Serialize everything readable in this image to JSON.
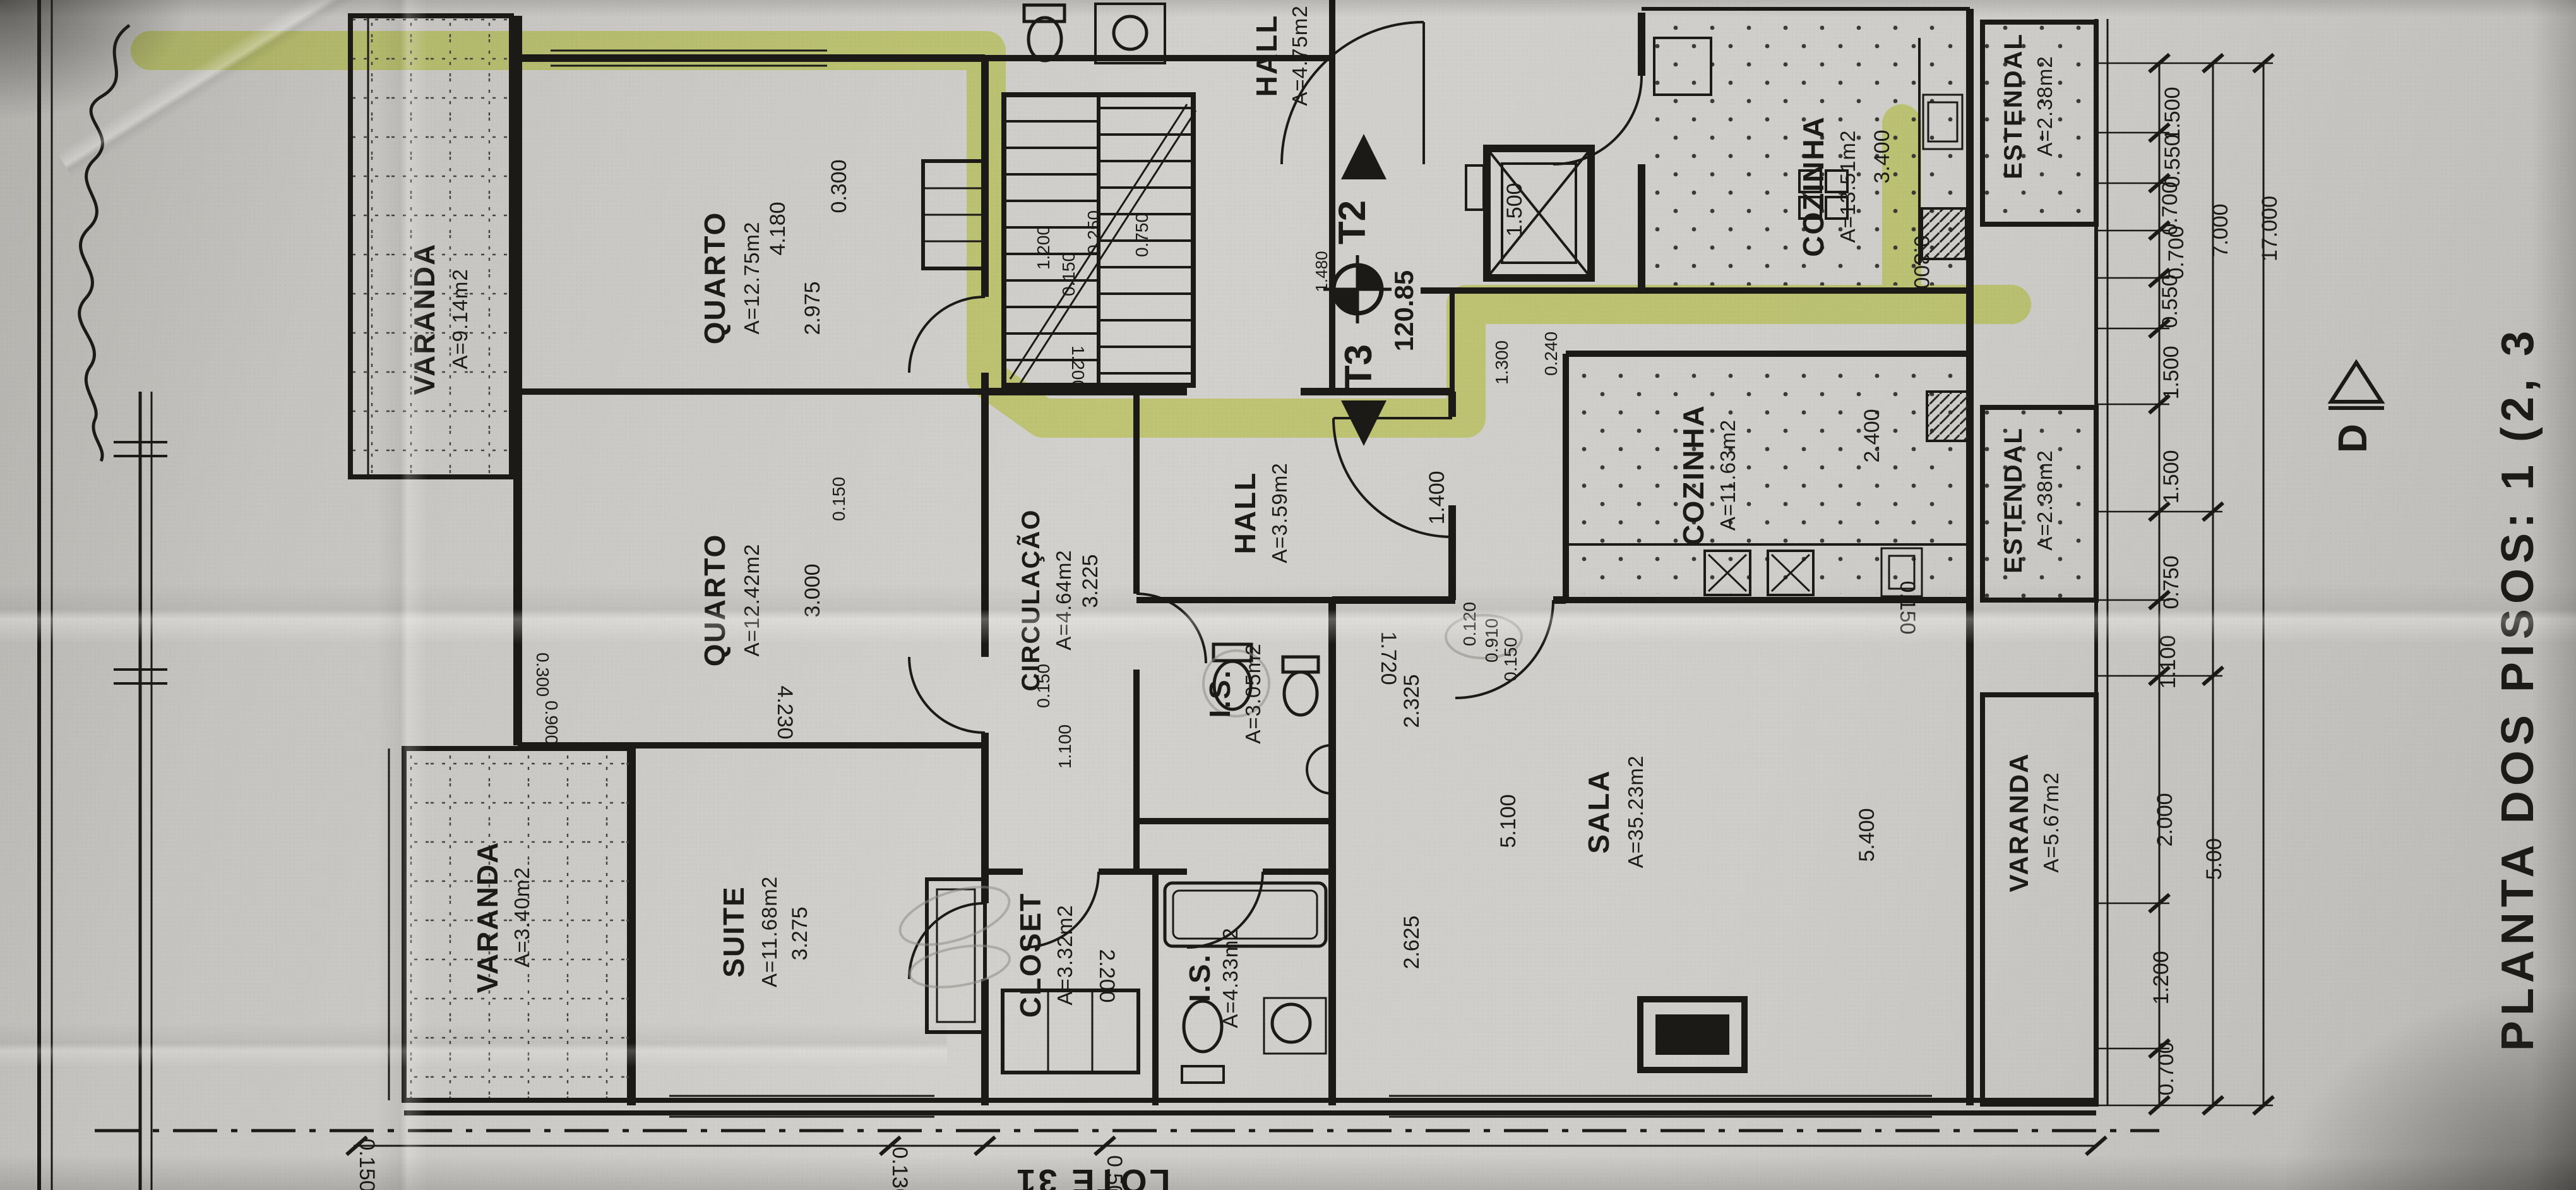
{
  "title": "PLANTA DOS PISOS: 1 (2, 3",
  "lot_label": "LOTE 31",
  "section_marker": "D",
  "markers": {
    "t2": "T2",
    "t3": "T3",
    "level": "120.85",
    "level_sub": "1.480"
  },
  "rooms": [
    {
      "label": "VARANDA",
      "area": "A=9.14m2"
    },
    {
      "label": "QUARTO",
      "area": "A=12.75m2"
    },
    {
      "label": "QUARTO",
      "area": "A=12.42m2"
    },
    {
      "label": "SUITE",
      "area": "A=11.68m2"
    },
    {
      "label": "VARANDA",
      "area": "A=3.40m2"
    },
    {
      "label": "CLOSET",
      "area": "A=3.32m2"
    },
    {
      "label": "I.S.",
      "area": "A=3.05m2"
    },
    {
      "label": "I.S.",
      "area": "A=4.33m2"
    },
    {
      "label": "CIRCULAÇÃO",
      "area": "A=4.64m2"
    },
    {
      "label": "HALL",
      "area": "A=3.59m2"
    },
    {
      "label": "HALL",
      "area": "A=4.75m2"
    },
    {
      "label": "SALA",
      "area": "A=35.23m2"
    },
    {
      "label": "COZINHA",
      "area": "A=13.51m2"
    },
    {
      "label": "COZINHA",
      "area": "A=11.63m2"
    },
    {
      "label": "ESTENDAL",
      "area": "A=2.38m2"
    },
    {
      "label": "ESTENDAL",
      "area": "A=2.38m2"
    },
    {
      "label": "VARANDA",
      "area": "A=5.67m2"
    }
  ],
  "dims": [
    "1.500",
    "0.550",
    "0.700",
    "0.700",
    "0.550",
    "1.500",
    "1.500",
    "0.750",
    "1.100",
    "2.000",
    "1.200",
    "0.700",
    "7.000",
    "5.00",
    "17.000",
    "0.300",
    "4.180",
    "2.975",
    "3.000",
    "4.230",
    "3.275",
    "2.200",
    "3.225",
    "0.150",
    "1.100",
    "1.400",
    "1.720",
    "2.325",
    "0.120",
    "0.910",
    "0.150",
    "5.100",
    "5.400",
    "2.625",
    "3.400",
    "0.300",
    "2.400",
    "0.150",
    "1.500",
    "1.300",
    "0.240",
    "1.200",
    "0.250",
    "0.750",
    "0.150",
    "1.200",
    "0.300",
    "0.900",
    "0.130",
    "0.50",
    "0.150",
    "0.150"
  ]
}
